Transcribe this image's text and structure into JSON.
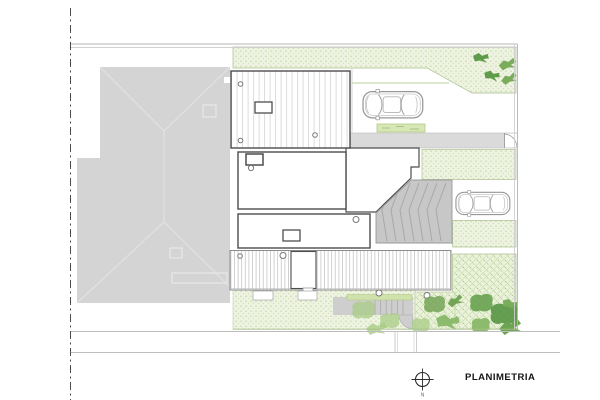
{
  "drawing": {
    "title": "PLANIMETRIA",
    "compass": {
      "north_label": "N"
    }
  },
  "icons": {
    "compass": "crosshair-circle-icon",
    "car": "car-top-view-icon",
    "bush": "leaf-cluster-icon"
  },
  "palette": {
    "neighbor_roof_gray": "#d4d4d4",
    "paving_gray": "#dadada",
    "ramp_gray": "#c7c7c7",
    "walkway_gray": "#cecece",
    "vegetation_bg": "#eef3e1",
    "vegetation_dots": "#a4c07f",
    "hedge_green": "#cfe2ab",
    "bush_dark_green": "#4f8f3b",
    "bush_light_green": "#a9cc85",
    "outline_dark": "#4d4d4d",
    "boundary_gray": "#b5b5b5"
  }
}
